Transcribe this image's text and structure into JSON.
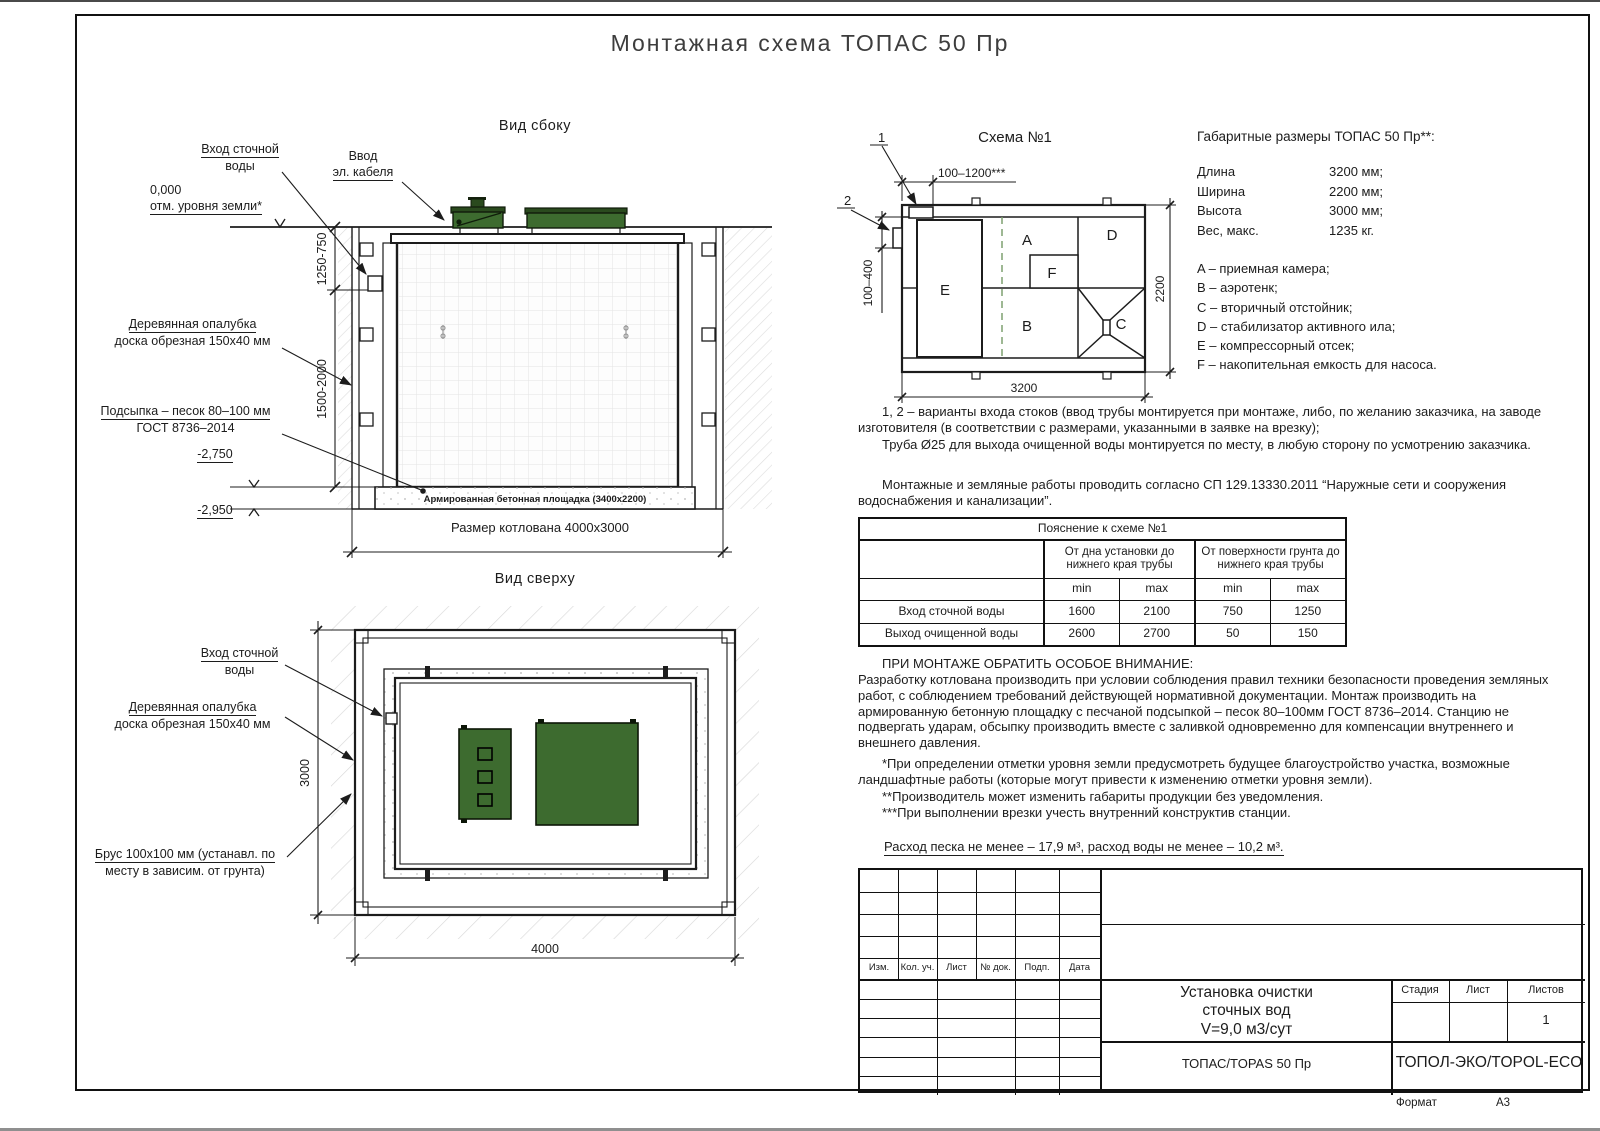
{
  "page": {
    "title": "Монтажная схема ТОПАС 50 Пр",
    "format_label": "Формат",
    "format_value": "А3"
  },
  "side_view": {
    "title": "Вид сбоку",
    "label_inlet_1": "Вход сточной",
    "label_inlet_2": "воды",
    "label_cable_1": "Ввод",
    "label_cable_2": "эл. кабеля",
    "level_zero": "0,000",
    "level_zero_sub": "отм. уровня земли*",
    "dim_1250_750": "1250-750",
    "dim_1500_2000": "1500-2000",
    "label_formwork_1": "Деревянная опалубка",
    "label_formwork_2": "доска обрезная 150х40 мм",
    "label_sand_1": "Подсыпка – песок 80–100 мм",
    "label_sand_2": "ГОСТ 8736–2014",
    "level_2750": "-2,750",
    "level_2950": "-2,950",
    "label_slab": "Армированная бетонная площадка (3400х2200)",
    "dim_pit": "Размер котлована 4000х3000"
  },
  "scheme1": {
    "title": "Схема №1",
    "callout_1": "1",
    "callout_2": "2",
    "dim_top": "100–1200***",
    "dim_left": "100–400",
    "dim_right": "2200",
    "dim_bottom": "3200",
    "comp_a": "A",
    "comp_b": "B",
    "comp_c": "C",
    "comp_d": "D",
    "comp_e": "E",
    "comp_f": "F"
  },
  "dimensions_block": {
    "title": "Габаритные размеры ТОПАС 50 Пр**:",
    "rows": [
      {
        "label": "Длина",
        "value": "3200 мм;"
      },
      {
        "label": "Ширина",
        "value": "2200 мм;"
      },
      {
        "label": "Высота",
        "value": "3000 мм;"
      },
      {
        "label": "Вес, макс.",
        "value": "1235 кг."
      }
    ],
    "legend": [
      "A – приемная камера;",
      "B – аэротенк;",
      "C – вторичный отстойник;",
      "D – стабилизатор активного ила;",
      "E – компрессорный отсек;",
      "F – накопительная емкость для насоса."
    ]
  },
  "notes": {
    "variants": "1, 2 – варианты входа  стоков (ввод трубы монтируется при монтаже, либо, по желанию заказчика, на заводе изготовителя (в соответствии с размерами, указанными в заявке на врезку);",
    "pipe": "Труба Ø25 для выхода очищенной воды монтируется по месту, в любую сторону по усмотрению заказчика.",
    "sp": "Монтажные и земляные работы проводить согласно СП 129.13330.2011 “Наружные сети и сооружения водоснабжения и канализации”."
  },
  "table": {
    "title": "Пояснение к схеме №1",
    "group1": "От дна установки до нижнего края трубы",
    "group2": "От поверхности грунта до нижнего края трубы",
    "min1": "min",
    "max1": "max",
    "min2": "min",
    "max2": "max",
    "rows": [
      {
        "label": "Вход сточной воды",
        "v1": "1600",
        "v2": "2100",
        "v3": "750",
        "v4": "1250"
      },
      {
        "label": "Выход очищенной воды",
        "v1": "2600",
        "v2": "2700",
        "v3": "50",
        "v4": "150"
      }
    ]
  },
  "attention": {
    "heading": "ПРИ МОНТАЖЕ ОБРАТИТЬ ОСОБОЕ ВНИМАНИЕ:",
    "body": "Разработку котлована производить при условии соблюдения правил техники безопасности проведения земляных работ, с соблюдением требований действующей нормативной документации.  Монтаж производить на армированную бетонную площадку с песчаной подсыпкой – песок 80–100мм ГОСТ 8736–2014. Станцию не подвергать ударам, обсыпку производить вместе с заливкой одновременно для компенсации внутреннего и внешнего давления.",
    "note1": "*При определении отметки уровня земли предусмотреть будущее благоустройство участка, возможные ландшафтные работы (которые могут привести к изменению отметки уровня земли).",
    "note2": "**Производитель может изменить габариты продукции без уведомления.",
    "note3": "***При выполнении врезки учесть внутренний конструктив станции.",
    "consumption": "Расход песка не менее – 17,9 м³, расход воды не менее – 10,2 м³."
  },
  "top_view": {
    "title": "Вид сверху",
    "label_inlet_1": "Вход сточной",
    "label_inlet_2": "воды",
    "label_formwork_1": "Деревянная опалубка",
    "label_formwork_2": "доска обрезная 150х40 мм",
    "label_beam_1": "Брус 100х100 мм (устанавл. по",
    "label_beam_2": "месту в зависим. от грунта)",
    "dim_height": "3000",
    "dim_width": "4000"
  },
  "title_block": {
    "stamp_cols": [
      "Изм.",
      "Кол. уч.",
      "Лист",
      "№ док.",
      "Подп.",
      "Дата"
    ],
    "doc_title": "Установка очистки\nсточных вод\nV=9,0 м3/сут",
    "stage_label": "Стадия",
    "sheet_label": "Лист",
    "sheets_label": "Листов",
    "sheets_value": "1",
    "product": "ТОПАС/TOPAS 50 Пр",
    "company": "ТОПОЛ-ЭКО/TOPOL-ECO"
  }
}
